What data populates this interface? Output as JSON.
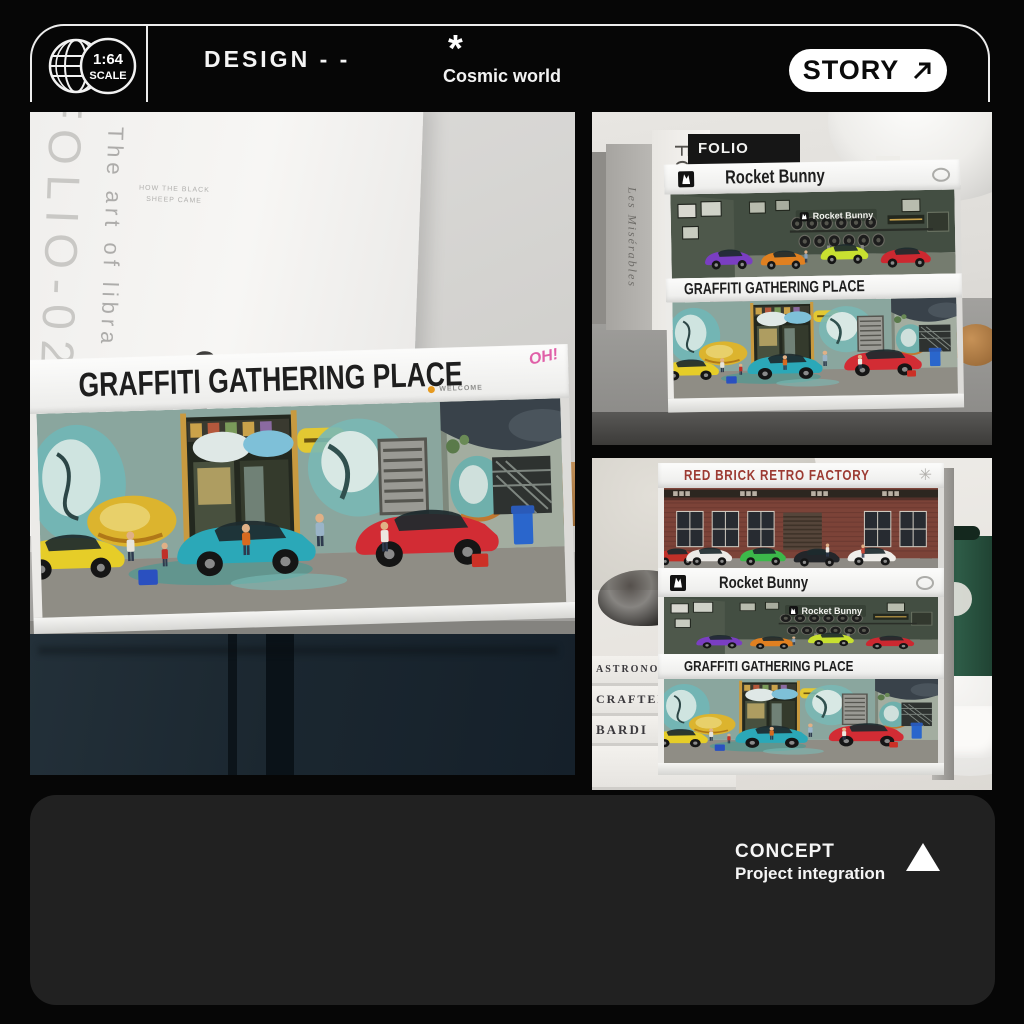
{
  "frame": {
    "scale_ratio": "1:64",
    "scale_label": "SCALE",
    "design_label": "DESIGN - -",
    "asterisk": "*",
    "subtitle": "Cosmic world",
    "story_label": "STORY"
  },
  "left_photo": {
    "book_spine": "FOLIO-02",
    "book_side_text": "The art of libra",
    "book_note": "HOW THE BLACK SHEEP CAME",
    "book_title": "Comp",
    "banner": "GRAFFITI GATHERING PLACE",
    "welcome_label": "WELCOME",
    "brand_mark": "OH!"
  },
  "top_right_photo": {
    "folio_tab": "FOLIO",
    "white_book_spine": "FOLIO-02",
    "gray_book_spine": "Les Misérables",
    "banner_top": "Rocket Bunny",
    "interior_sign": "Rocket Bunny",
    "banner_bottom": "GRAFFITI GATHERING PLACE"
  },
  "bottom_right_photo": {
    "banner_top": "RED BRICK RETRO FACTORY",
    "starburst": "✳",
    "banner_middle": "Rocket Bunny",
    "interior_sign": "Rocket Bunny",
    "banner_bottom": "GRAFFITI GATHERING PLACE",
    "book_spines": [
      "ASTRONOMER",
      "CRAFTED",
      "BARDI"
    ]
  },
  "footer": {
    "title": "CONCEPT",
    "subtitle": "Project integration"
  },
  "colors": {
    "background": "#060606",
    "panel": "#212121",
    "accent_pink": "#e060a8",
    "brick_title": "#9c3a32"
  }
}
